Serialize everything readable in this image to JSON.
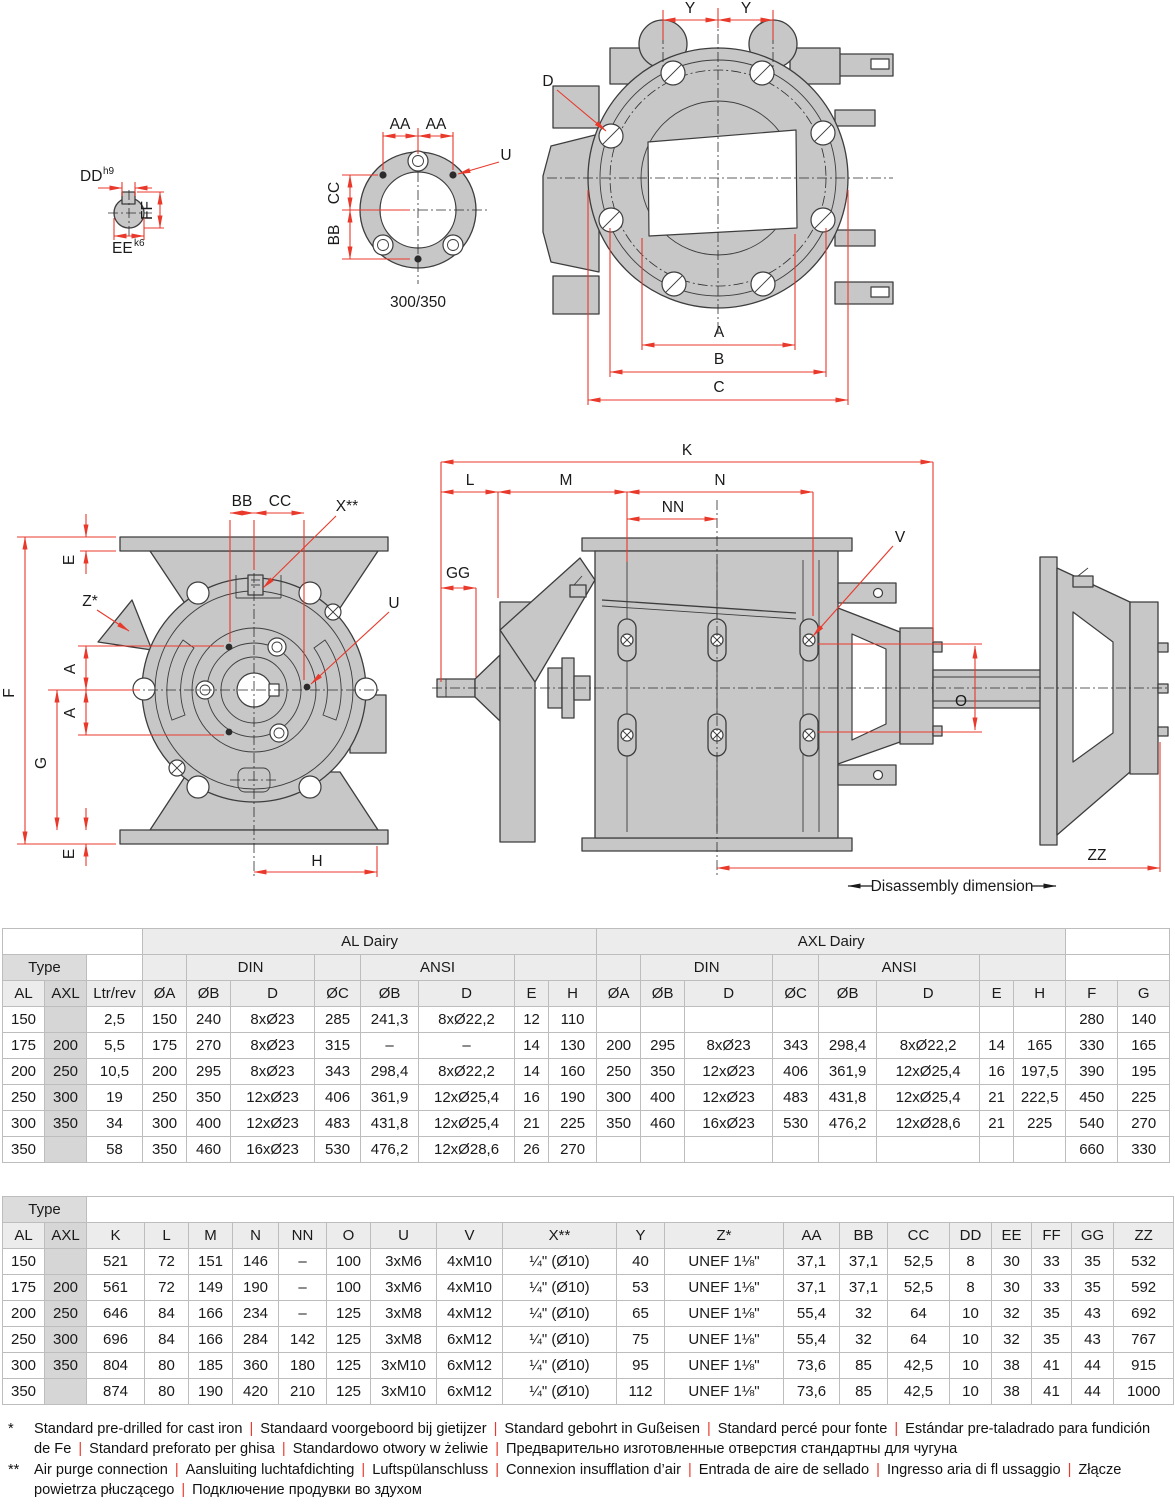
{
  "colors": {
    "accent_red": "#e8392b",
    "drawing_fill": "#c7c7c7",
    "table_header_bg": "#ececec",
    "type_header_bg": "#dcdcdc",
    "axl_column_bg": "#d6d6d6"
  },
  "drawings": {
    "shaft_section": {
      "labels": {
        "dd": "DD",
        "dd_sup": "h9",
        "ff": "FF",
        "ee": "EE",
        "ee_sup": "k6"
      }
    },
    "flange_view": {
      "labels": {
        "aa1": "AA",
        "aa2": "AA",
        "cc": "CC",
        "bb": "BB",
        "u": "U"
      },
      "caption": "300/350"
    },
    "front_top_view": {
      "labels": {
        "y1": "Y",
        "y2": "Y",
        "d": "D",
        "a": "A",
        "b": "B",
        "c": "C"
      }
    },
    "front_view": {
      "labels": {
        "bb": "BB",
        "cc": "CC",
        "x": "X**",
        "u": "U",
        "z": "Z*",
        "e_top": "E",
        "f": "F",
        "a1": "A",
        "a2": "A",
        "g": "G",
        "e_bottom": "E",
        "h": "H"
      }
    },
    "side_view": {
      "labels": {
        "k": "K",
        "l": "L",
        "m": "M",
        "n": "N",
        "nn": "NN",
        "gg": "GG",
        "v": "V",
        "o": "O",
        "zz": "ZZ"
      },
      "note": "Disassembly dimension"
    }
  },
  "table1": {
    "col_widths": [
      42,
      42,
      56,
      44,
      44,
      84,
      46,
      58,
      96,
      34,
      48,
      44,
      44,
      88,
      46,
      58,
      103,
      34,
      52,
      52,
      52
    ],
    "axl_cols": [
      1
    ],
    "header_rows": [
      [
        {
          "t": "",
          "k": "empty",
          "cs": 3
        },
        {
          "t": "AL Dairy",
          "k": "group",
          "cs": 8
        },
        {
          "t": "AXL Dairy",
          "k": "group",
          "cs": 8
        },
        {
          "t": "",
          "k": "empty",
          "cs": 2
        }
      ],
      [
        {
          "t": "Type",
          "k": "type",
          "cs": 2
        },
        {
          "t": "",
          "k": "empty",
          "cs": 1
        },
        {
          "t": "",
          "k": "band",
          "cs": 1
        },
        {
          "t": "DIN",
          "k": "sub",
          "cs": 2
        },
        {
          "t": "",
          "k": "band",
          "cs": 1
        },
        {
          "t": "ANSI",
          "k": "sub",
          "cs": 2
        },
        {
          "t": "",
          "k": "band",
          "cs": 2
        },
        {
          "t": "",
          "k": "band",
          "cs": 1
        },
        {
          "t": "DIN",
          "k": "sub",
          "cs": 2
        },
        {
          "t": "",
          "k": "band",
          "cs": 1
        },
        {
          "t": "ANSI",
          "k": "sub",
          "cs": 2
        },
        {
          "t": "",
          "k": "band",
          "cs": 2
        },
        {
          "t": "",
          "k": "empty",
          "cs": 2
        }
      ],
      [
        {
          "t": "AL",
          "k": "col"
        },
        {
          "t": "AXL",
          "k": "col axl"
        },
        {
          "t": "Ltr/rev",
          "k": "col"
        },
        {
          "t": "ØA",
          "k": "col"
        },
        {
          "t": "ØB",
          "k": "col"
        },
        {
          "t": "D",
          "k": "col"
        },
        {
          "t": "ØC",
          "k": "col"
        },
        {
          "t": "ØB",
          "k": "col"
        },
        {
          "t": "D",
          "k": "col"
        },
        {
          "t": "E",
          "k": "col"
        },
        {
          "t": "H",
          "k": "col"
        },
        {
          "t": "ØA",
          "k": "col"
        },
        {
          "t": "ØB",
          "k": "col"
        },
        {
          "t": "D",
          "k": "col"
        },
        {
          "t": "ØC",
          "k": "col"
        },
        {
          "t": "ØB",
          "k": "col"
        },
        {
          "t": "D",
          "k": "col"
        },
        {
          "t": "E",
          "k": "col"
        },
        {
          "t": "H",
          "k": "col"
        },
        {
          "t": "F",
          "k": "col"
        },
        {
          "t": "G",
          "k": "col"
        }
      ]
    ],
    "rows": [
      [
        "150",
        "",
        "2,5",
        "150",
        "240",
        "8xØ23",
        "285",
        "241,3",
        "8xØ22,2",
        "12",
        "110",
        "",
        "",
        "",
        "",
        "",
        "",
        "",
        "",
        "280",
        "140"
      ],
      [
        "175",
        "200",
        "5,5",
        "175",
        "270",
        "8xØ23",
        "315",
        "–",
        "–",
        "14",
        "130",
        "200",
        "295",
        "8xØ23",
        "343",
        "298,4",
        "8xØ22,2",
        "14",
        "165",
        "330",
        "165"
      ],
      [
        "200",
        "250",
        "10,5",
        "200",
        "295",
        "8xØ23",
        "343",
        "298,4",
        "8xØ22,2",
        "14",
        "160",
        "250",
        "350",
        "12xØ23",
        "406",
        "361,9",
        "12xØ25,4",
        "16",
        "197,5",
        "390",
        "195"
      ],
      [
        "250",
        "300",
        "19",
        "250",
        "350",
        "12xØ23",
        "406",
        "361,9",
        "12xØ25,4",
        "16",
        "190",
        "300",
        "400",
        "12xØ23",
        "483",
        "431,8",
        "12xØ25,4",
        "21",
        "222,5",
        "450",
        "225"
      ],
      [
        "300",
        "350",
        "34",
        "300",
        "400",
        "12xØ23",
        "483",
        "431,8",
        "12xØ25,4",
        "21",
        "225",
        "350",
        "460",
        "16xØ23",
        "530",
        "476,2",
        "12xØ28,6",
        "21",
        "225",
        "540",
        "270"
      ],
      [
        "350",
        "",
        "58",
        "350",
        "460",
        "16xØ23",
        "530",
        "476,2",
        "12xØ28,6",
        "26",
        "270",
        "",
        "",
        "",
        "",
        "",
        "",
        "",
        "",
        "660",
        "330"
      ]
    ]
  },
  "table2": {
    "col_widths": [
      42,
      42,
      58,
      44,
      44,
      46,
      48,
      44,
      66,
      66,
      114,
      48,
      119,
      56,
      48,
      62,
      42,
      40,
      40,
      42,
      60
    ],
    "axl_cols": [
      1
    ],
    "header_rows": [
      [
        {
          "t": "Type",
          "k": "type",
          "cs": 2
        },
        {
          "t": "",
          "k": "empty",
          "cs": 19
        }
      ],
      [
        {
          "t": "AL",
          "k": "col"
        },
        {
          "t": "AXL",
          "k": "col axl"
        },
        {
          "t": "K",
          "k": "col"
        },
        {
          "t": "L",
          "k": "col"
        },
        {
          "t": "M",
          "k": "col"
        },
        {
          "t": "N",
          "k": "col"
        },
        {
          "t": "NN",
          "k": "col"
        },
        {
          "t": "O",
          "k": "col"
        },
        {
          "t": "U",
          "k": "col"
        },
        {
          "t": "V",
          "k": "col"
        },
        {
          "t": "X**",
          "k": "col"
        },
        {
          "t": "Y",
          "k": "col"
        },
        {
          "t": "Z*",
          "k": "col"
        },
        {
          "t": "AA",
          "k": "col"
        },
        {
          "t": "BB",
          "k": "col"
        },
        {
          "t": "CC",
          "k": "col"
        },
        {
          "t": "DD",
          "k": "col"
        },
        {
          "t": "EE",
          "k": "col"
        },
        {
          "t": "FF",
          "k": "col"
        },
        {
          "t": "GG",
          "k": "col"
        },
        {
          "t": "ZZ",
          "k": "col"
        }
      ]
    ],
    "rows": [
      [
        "150",
        "",
        "521",
        "72",
        "151",
        "146",
        "–",
        "100",
        "3xM6",
        "4xM10",
        "¼\" (Ø10)",
        "40",
        "UNEF 1⅛\"",
        "37,1",
        "37,1",
        "52,5",
        "8",
        "30",
        "33",
        "35",
        "532"
      ],
      [
        "175",
        "200",
        "561",
        "72",
        "149",
        "190",
        "–",
        "100",
        "3xM6",
        "4xM10",
        "¼\" (Ø10)",
        "53",
        "UNEF 1⅛\"",
        "37,1",
        "37,1",
        "52,5",
        "8",
        "30",
        "33",
        "35",
        "592"
      ],
      [
        "200",
        "250",
        "646",
        "84",
        "166",
        "234",
        "–",
        "125",
        "3xM8",
        "4xM12",
        "¼\" (Ø10)",
        "65",
        "UNEF 1⅛\"",
        "55,4",
        "32",
        "64",
        "10",
        "32",
        "35",
        "43",
        "692"
      ],
      [
        "250",
        "300",
        "696",
        "84",
        "166",
        "284",
        "142",
        "125",
        "3xM8",
        "6xM12",
        "¼\" (Ø10)",
        "75",
        "UNEF 1⅛\"",
        "55,4",
        "32",
        "64",
        "10",
        "32",
        "35",
        "43",
        "767"
      ],
      [
        "300",
        "350",
        "804",
        "80",
        "185",
        "360",
        "180",
        "125",
        "3xM10",
        "6xM12",
        "¼\" (Ø10)",
        "95",
        "UNEF 1⅛\"",
        "73,6",
        "85",
        "42,5",
        "10",
        "38",
        "41",
        "44",
        "915"
      ],
      [
        "350",
        "",
        "874",
        "80",
        "190",
        "420",
        "210",
        "125",
        "3xM10",
        "6xM12",
        "¼\" (Ø10)",
        "112",
        "UNEF 1⅛\"",
        "73,6",
        "85",
        "42,5",
        "10",
        "38",
        "41",
        "44",
        "1000"
      ]
    ]
  },
  "footnotes": [
    {
      "marker": "*",
      "segments": [
        "Standard pre-drilled for cast iron",
        "Standaard voorgeboord bij gietijzer",
        "Standard gebohrt in Gußeisen",
        "Standard percé pour fonte",
        "Estándar pre-taladrado para fundición de Fe",
        "Standard preforato per ghisa",
        "Standardowo otwory w żeliwie",
        "Предварительно изготовленные отверстия стандартны для чугуна"
      ]
    },
    {
      "marker": "**",
      "segments": [
        "Air purge connection",
        "Aansluiting luchtafdichting",
        "Luftspülanschluss",
        "Connexion insufflation d’air",
        "Entrada de aire de sellado",
        "Ingresso aria di fl ussaggio",
        "Złącze powietrza płuczącego",
        "Подключение продувки во  здухом"
      ]
    }
  ]
}
